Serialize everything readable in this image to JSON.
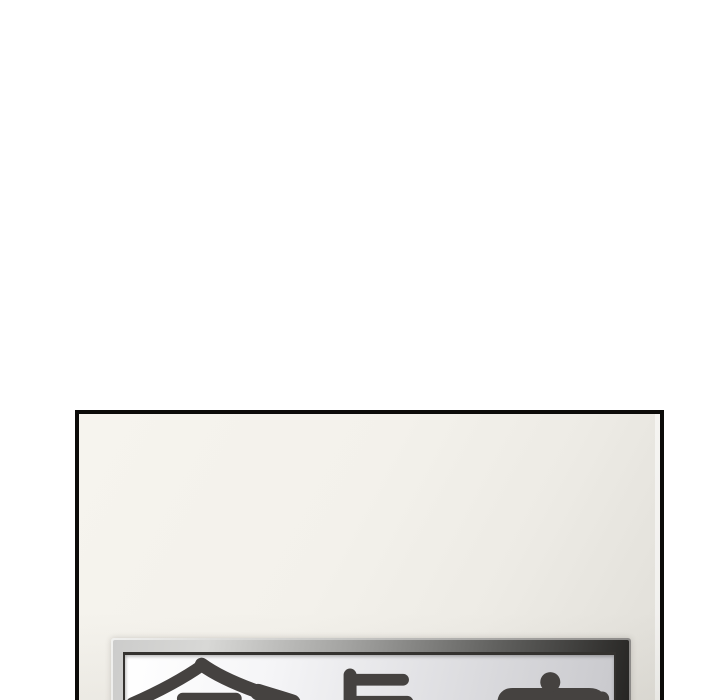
{
  "canvas": {
    "width": 720,
    "height": 700,
    "background_hex": "#ffffff"
  },
  "panel": {
    "border_hex": "#0c0b09",
    "wall_light_hex": "#f6f4ee",
    "wall_dark_hex": "#e0ded8"
  },
  "sign": {
    "text": "會長室",
    "characters": [
      "會",
      "長",
      "室"
    ],
    "text_color_hex": "#454240",
    "plate_light_hex": "#ffffff",
    "plate_dark_hex": "#c9c9cd",
    "frame_light_hex": "#d8d8d6",
    "frame_dark_hex": "#262523",
    "seam_hex": "#34322f"
  }
}
